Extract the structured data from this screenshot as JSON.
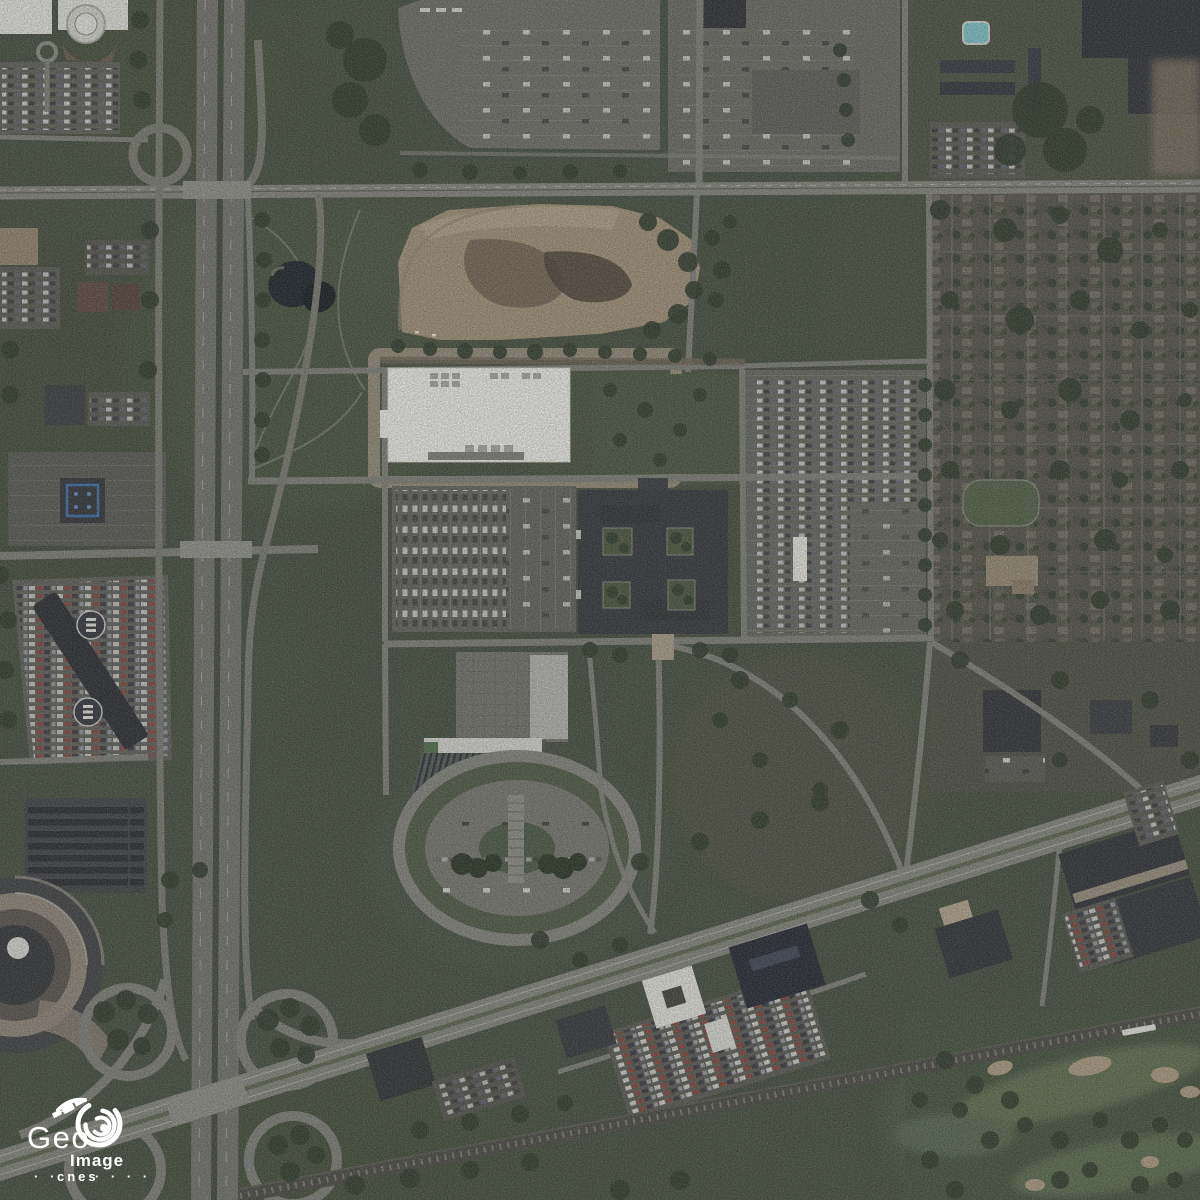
{
  "scene": {
    "type": "satellite-imagery",
    "description": "Aerial satellite photograph of a suburban area: vertical freeway with cloverleaf interchange, diagonal boulevard and railroad, shopping mall with large parking lots, white big-box store, construction site, office campuses, dense residential neighborhood and golf course"
  },
  "watermark": {
    "brand_primary": "Geo",
    "brand_secondary": "Image",
    "agency": "cnes",
    "dots_left": "· ·",
    "dots_right": "· · · ·",
    "text_color": "#ffffff"
  },
  "palette": {
    "grass": "#3e4737",
    "forest": "#2b3626",
    "road": "#7d7d76",
    "freeway": "#70706a",
    "concrete": "#9a9a93",
    "parking": "#5e5e58",
    "dirt": "#a09176",
    "building_white": "#f3f3ee",
    "building_dark": "#2f3236",
    "building_navy": "#1d222b",
    "water": "#131b21",
    "pool": "#7cc7c9",
    "sand": "#ac9c7e"
  }
}
